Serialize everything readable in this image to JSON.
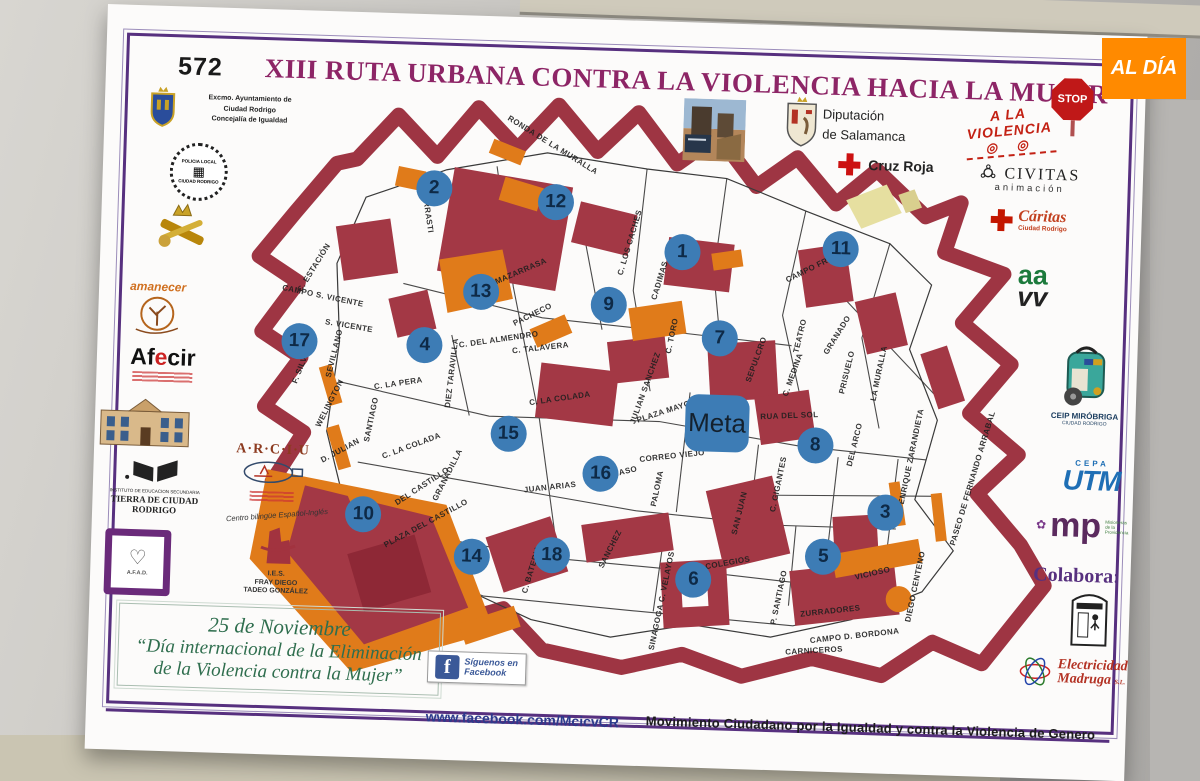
{
  "photo": {
    "watermark": "AL DÍA"
  },
  "poster": {
    "header": {
      "number": "572",
      "title": "XIII RUTA URBANA CONTRA LA VIOLENCIA HACIA LA MUJER"
    },
    "top": {
      "ayuntamiento": {
        "l1": "Excmo. Ayuntamiento de",
        "l2": "Ciudad Rodrigo",
        "l3": "Concejalía de Igualdad"
      },
      "diputacion": {
        "l1": "Diputación",
        "l2": "de Salamanca"
      },
      "cruz_roja": {
        "label": "Cruz Roja"
      }
    },
    "left": {
      "policia": {
        "l1": "POLICIA LOCAL",
        "l2": "CIUDAD RODRIGO"
      },
      "amanecer": {
        "label": "amanecer"
      },
      "afecir": {
        "p1": "Af",
        "p2": "e",
        "p3": "cir"
      },
      "ies_tierra": {
        "l1": "INSTITUTO DE EDUCACION SECUNDARIA",
        "l2": "TIERRA DE CIUDAD RODRIGO"
      },
      "afad": {
        "label": "A.F.A.D."
      },
      "arciu": {
        "label": "A·R·C·I·U"
      },
      "bilingue": {
        "label": "Centro bilingüe Español-Inglés"
      },
      "fray": {
        "l1": "I.E.S.",
        "l2": "FRAY DIEGO",
        "l3": "TADEO GONZÁLEZ"
      }
    },
    "right": {
      "stop": {
        "label": "STOP"
      },
      "violencia": {
        "label": "A LA VIOLENCIA",
        "targets": "◎ ◎"
      },
      "civitas": {
        "l1": "CIVITAS",
        "l2": "animación"
      },
      "caritas": {
        "l1": "Cáritas",
        "l2": "Ciudad Rodrigo"
      },
      "aavv": {
        "l1": "aa",
        "l2": "vv"
      },
      "ceip": {
        "l1": "CEIP MIRÓBRIGA",
        "l2": "CIUDAD RODRIGO"
      },
      "cepa": {
        "l1": "CEPA",
        "l2": "UTM"
      },
      "mp": {
        "l1": "mp",
        "l2": "Misioneras de la Providencia"
      },
      "colabora": {
        "label": "Colabora:"
      },
      "electricidad": {
        "l1": "Electricidad",
        "l2": "Madruga",
        "l3": "S.L."
      }
    },
    "footer": {
      "date": "25 de Noviembre",
      "quote1": "“Día internacional de la Eliminación",
      "quote2": "de la Violencia contra la Mujer”",
      "facebook": {
        "f": "f",
        "l1": "Síguenos en",
        "l2": "Facebook"
      },
      "url": "www.facebook.com/McicvCR",
      "movement": "Movimiento Ciudadano por la Igualdad y contra la Violencia de Genero"
    }
  },
  "map": {
    "meta": {
      "label": "Meta",
      "x": 53.7,
      "y": 55.0
    },
    "checkpoints": [
      {
        "n": "1",
        "x": 49.2,
        "y": 26.7
      },
      {
        "n": "2",
        "x": 21.1,
        "y": 17.3
      },
      {
        "n": "3",
        "x": 72.9,
        "y": 69.0
      },
      {
        "n": "4",
        "x": 20.6,
        "y": 43.5
      },
      {
        "n": "5",
        "x": 66.1,
        "y": 76.7
      },
      {
        "n": "6",
        "x": 51.6,
        "y": 81.2
      },
      {
        "n": "7",
        "x": 53.7,
        "y": 40.8
      },
      {
        "n": "8",
        "x": 64.8,
        "y": 58.2
      },
      {
        "n": "9",
        "x": 41.1,
        "y": 35.8
      },
      {
        "n": "10",
        "x": 14.3,
        "y": 72.0
      },
      {
        "n": "11",
        "x": 67.0,
        "y": 25.3
      },
      {
        "n": "12",
        "x": 34.8,
        "y": 19.0
      },
      {
        "n": "13",
        "x": 26.7,
        "y": 34.3
      },
      {
        "n": "14",
        "x": 26.6,
        "y": 78.5
      },
      {
        "n": "15",
        "x": 30.3,
        "y": 57.8
      },
      {
        "n": "16",
        "x": 40.8,
        "y": 64.0
      },
      {
        "n": "17",
        "x": 6.5,
        "y": 43.5
      },
      {
        "n": "18",
        "x": 35.6,
        "y": 77.8
      }
    ],
    "streets": [
      {
        "name": "RONDA DE LA MURALLA",
        "x": 34.3,
        "y": 9.5,
        "r": 30
      },
      {
        "name": "HERRASTI",
        "x": 20.4,
        "y": 21.2,
        "r": 80
      },
      {
        "name": "C. ESTACIÓN",
        "x": 7.9,
        "y": 31.2,
        "r": -60
      },
      {
        "name": "CAMPO S. VICENTE",
        "x": 9.0,
        "y": 35.8,
        "r": 10
      },
      {
        "name": "S. VICENTE",
        "x": 12.0,
        "y": 40.7,
        "r": 8
      },
      {
        "name": "SEVILLANO",
        "x": 10.4,
        "y": 45.3,
        "r": -78
      },
      {
        "name": "F. SILVA",
        "x": 6.7,
        "y": 47.8,
        "r": -70
      },
      {
        "name": "WELINGTON",
        "x": 10.1,
        "y": 53.7,
        "r": -65
      },
      {
        "name": "SANTIAGO",
        "x": 14.8,
        "y": 56.2,
        "r": -80
      },
      {
        "name": "D. JULIAN",
        "x": 11.5,
        "y": 61.5,
        "r": -30
      },
      {
        "name": "C. LA PERA",
        "x": 17.8,
        "y": 50.0,
        "r": -10
      },
      {
        "name": "C. LA COLADA",
        "x": 19.4,
        "y": 60.3,
        "r": -22
      },
      {
        "name": "C. LA COLADA",
        "x": 36.0,
        "y": 51.7,
        "r": -10
      },
      {
        "name": "C. DEL ALMENDRO",
        "x": 28.9,
        "y": 42.2,
        "r": -10
      },
      {
        "name": "C. TALAVERA",
        "x": 33.6,
        "y": 43.3,
        "r": -8
      },
      {
        "name": "DIEZ TARAVILLA",
        "x": 23.7,
        "y": 48.0,
        "r": -85
      },
      {
        "name": "PACHECO",
        "x": 32.6,
        "y": 37.8,
        "r": -28
      },
      {
        "name": "MAZARRASA",
        "x": 31.1,
        "y": 30.7,
        "r": -25
      },
      {
        "name": "C. LOS CACHES",
        "x": 43.3,
        "y": 25.3,
        "r": -75
      },
      {
        "name": "CADIMAS",
        "x": 46.7,
        "y": 31.5,
        "r": -75
      },
      {
        "name": "CAMPO FRIO",
        "x": 63.7,
        "y": 28.7,
        "r": -28
      },
      {
        "name": "C. TORO",
        "x": 48.3,
        "y": 40.7,
        "r": -80
      },
      {
        "name": "JULIAN SANCHEZ",
        "x": 45.5,
        "y": 49.5,
        "r": -72
      },
      {
        "name": "SEPULCRO",
        "x": 57.9,
        "y": 44.2,
        "r": -72
      },
      {
        "name": "TEATRO",
        "x": 62.7,
        "y": 40.0,
        "r": -78
      },
      {
        "name": "C. MEDINA",
        "x": 62.0,
        "y": 46.5,
        "r": -72
      },
      {
        "name": "GRANADO",
        "x": 66.9,
        "y": 39.7,
        "r": -60
      },
      {
        "name": "PRISUELO",
        "x": 68.1,
        "y": 45.8,
        "r": -78
      },
      {
        "name": "LA MURALLA",
        "x": 71.7,
        "y": 45.8,
        "r": -80
      },
      {
        "name": "RUA DEL SOL",
        "x": 61.8,
        "y": 53.3,
        "r": -4
      },
      {
        "name": "PLAZA MAYOR",
        "x": 48.0,
        "y": 53.2,
        "r": -20
      },
      {
        "name": "CORREO VIEJO",
        "x": 48.8,
        "y": 60.7,
        "r": -8
      },
      {
        "name": "PALOMA",
        "x": 47.2,
        "y": 66.2,
        "r": -80
      },
      {
        "name": "MASO",
        "x": 43.5,
        "y": 63.5,
        "r": -15
      },
      {
        "name": "SAN JUAN",
        "x": 56.5,
        "y": 69.8,
        "r": -78
      },
      {
        "name": "C. GIGANTES",
        "x": 60.8,
        "y": 64.8,
        "r": -80
      },
      {
        "name": "DEL ARCO",
        "x": 69.2,
        "y": 57.8,
        "r": -78
      },
      {
        "name": "ENRIQUE ZARANDIETA",
        "x": 75.6,
        "y": 59.5,
        "r": -80
      },
      {
        "name": "PASEO DE FERNANDO ARRABAL",
        "x": 82.6,
        "y": 62.8,
        "r": -75
      },
      {
        "name": "DIEGO CENTENO",
        "x": 76.5,
        "y": 81.2,
        "r": -80
      },
      {
        "name": "VICIOSO",
        "x": 71.7,
        "y": 79.2,
        "r": -15
      },
      {
        "name": "ZURRADORES",
        "x": 67.1,
        "y": 85.7,
        "r": -8
      },
      {
        "name": "CAMPO D. BORDONA",
        "x": 69.9,
        "y": 89.7,
        "r": -8
      },
      {
        "name": "CARNICEROS",
        "x": 65.4,
        "y": 92.3,
        "r": -5
      },
      {
        "name": "P. SANTIAGO",
        "x": 61.2,
        "y": 83.7,
        "r": -80
      },
      {
        "name": "SINAGOGA C. VELAYOS",
        "x": 48.1,
        "y": 84.8,
        "r": -80
      },
      {
        "name": "COLEGIOS",
        "x": 55.4,
        "y": 78.2,
        "r": -12
      },
      {
        "name": "JUAN ARIAS",
        "x": 35.2,
        "y": 66.5,
        "r": -8
      },
      {
        "name": "PLAZA DEL CASTILLO",
        "x": 21.3,
        "y": 73.2,
        "r": -30
      },
      {
        "name": "DEL CASTILLO",
        "x": 20.8,
        "y": 67.0,
        "r": -35
      },
      {
        "name": "GRANADILLA",
        "x": 23.6,
        "y": 65.0,
        "r": -65
      },
      {
        "name": "C. BATERIA",
        "x": 33.4,
        "y": 80.3,
        "r": -75
      },
      {
        "name": "SANCHEZ",
        "x": 42.1,
        "y": 76.5,
        "r": -65
      }
    ]
  },
  "colors": {
    "accent_purple": "#57307f",
    "title_magenta": "#8d2566",
    "wall_red": "#9e3543",
    "building_orange": "#e07b1a",
    "checkpoint_blue": "#3d7cb5",
    "footer_green": "#2f6e4e",
    "facebook_blue": "#3b5998",
    "aldia_orange": "#ff8a00",
    "cruz_roja_red": "#cc1111"
  }
}
